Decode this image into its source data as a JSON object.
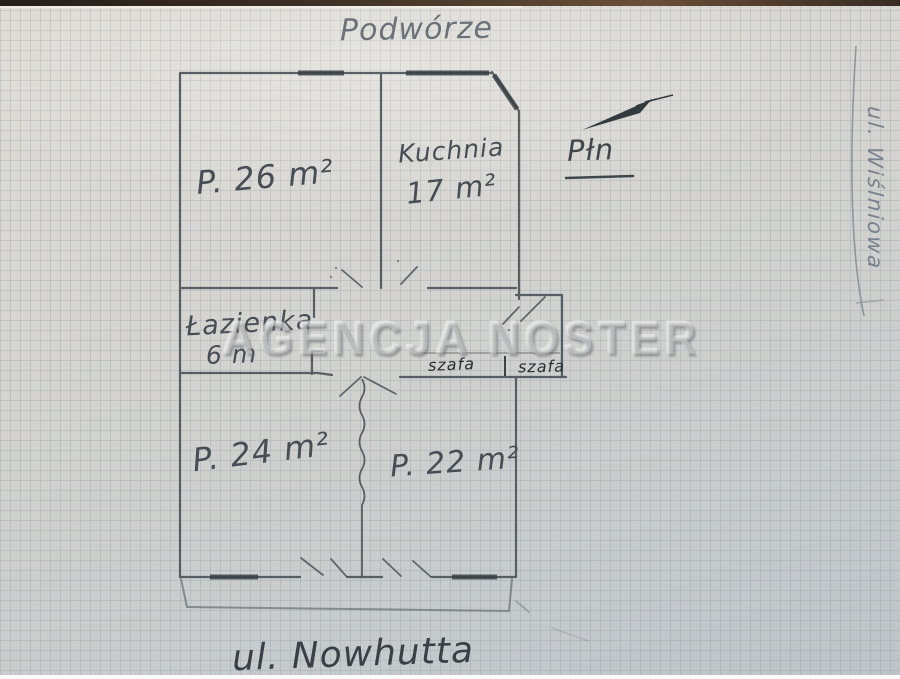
{
  "scene": {
    "top_label": "Podwórze",
    "bottom_label": "ul. Nowhutta",
    "side_label": "ul. Wiślniowa",
    "north_label": "Płn",
    "watermark": "AGENCJA NOSTER"
  },
  "rooms": {
    "room26": {
      "label": "P. 26 m²"
    },
    "kitchen": {
      "name": "Kuchnia",
      "area": "17 m²"
    },
    "bathroom": {
      "name": "Łazienka",
      "area": "6 m"
    },
    "room24": {
      "label": "P. 24 m²"
    },
    "room22": {
      "label": "P. 22 m²"
    },
    "closet_left": {
      "label": "szafa"
    },
    "closet_right": {
      "label": "szafa"
    }
  },
  "colors": {
    "pencil": "#4d565c",
    "pen_ink": "#2e3236",
    "window_stroke": "#394145",
    "paper_warm": "#dfdcd5",
    "paper_cool": "#bec4c7",
    "grid_line": "#7d91a5"
  }
}
